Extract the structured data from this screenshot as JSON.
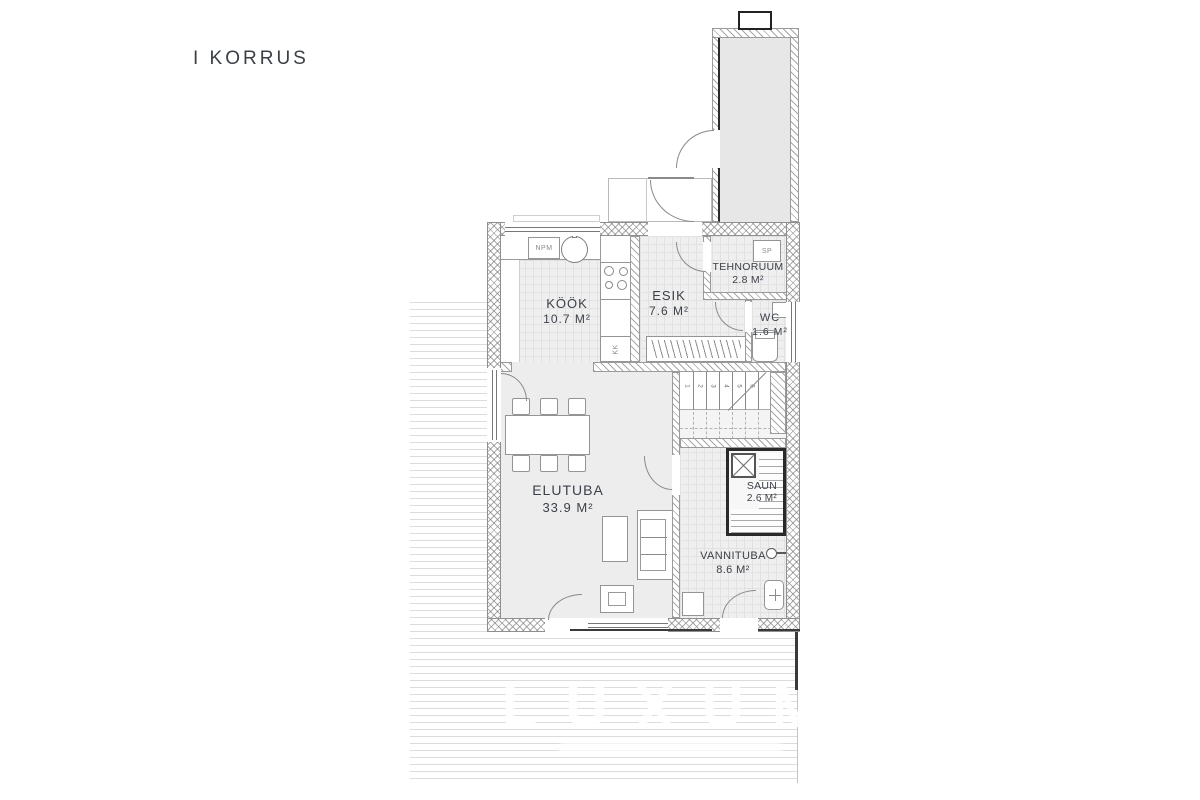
{
  "title": "I KORRUS",
  "watermark": "LUXUM",
  "rooms": [
    {
      "name": "KÖÖK",
      "area": "10.7 M²"
    },
    {
      "name": "ESIK",
      "area": "7.6 M²"
    },
    {
      "name": "TEHNORUUM",
      "area": "2.8 M²"
    },
    {
      "name": "WC",
      "area": "1.6 M²"
    },
    {
      "name": "ELUTUBA",
      "area": "33.9 M²"
    },
    {
      "name": "SAUN",
      "area": "2.6 M²"
    },
    {
      "name": "VANNITUBA",
      "area": "8.6 M²"
    }
  ],
  "fixtures": {
    "npm": "NPM",
    "kk": "KK",
    "sp": "SP"
  },
  "stairs": {
    "steps": [
      "1",
      "2",
      "3",
      "4",
      "5",
      "6"
    ]
  },
  "colors": {
    "label_text": "#3c4149",
    "wall_line": "#8a8a8a",
    "dark_line": "#222222",
    "floor": "#ededed"
  }
}
